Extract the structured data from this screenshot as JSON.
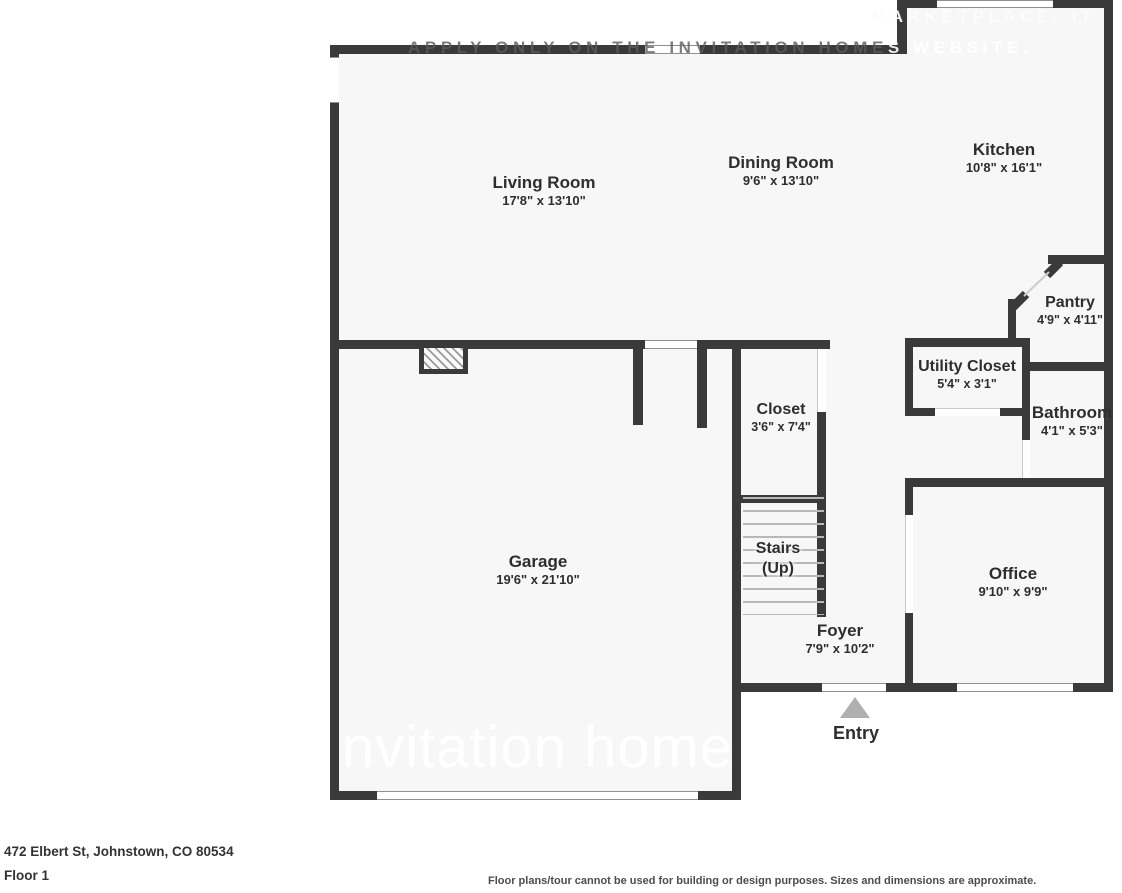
{
  "watermarks": {
    "top_line1": "MARKETPLACE, IT",
    "top_line2": "APPLY ONLY ON THE INVITATION HOMES WEBSITE.",
    "garage_logo": "invitation homes"
  },
  "rooms": {
    "living": {
      "name": "Living Room",
      "dims": "17'8\" x 13'10\""
    },
    "dining": {
      "name": "Dining Room",
      "dims": "9'6\" x 13'10\""
    },
    "kitchen": {
      "name": "Kitchen",
      "dims": "10'8\" x 16'1\""
    },
    "pantry": {
      "name": "Pantry",
      "dims": "4'9\" x 4'11\""
    },
    "utility": {
      "name": "Utility Closet",
      "dims": "5'4\" x 3'1\""
    },
    "bathroom": {
      "name": "Bathroom",
      "dims": "4'1\" x 5'3\""
    },
    "closet": {
      "name": "Closet",
      "dims": "3'6\" x 7'4\""
    },
    "stairs": {
      "name": "Stairs",
      "direction": "(Up)"
    },
    "garage": {
      "name": "Garage",
      "dims": "19'6\" x 21'10\""
    },
    "foyer": {
      "name": "Foyer",
      "dims": "7'9\" x 10'2\""
    },
    "office": {
      "name": "Office",
      "dims": "9'10\" x 9'9\""
    },
    "entry": {
      "name": "Entry"
    }
  },
  "footer": {
    "address": "472 Elbert St, Johnstown, CO 80534",
    "floor": "Floor 1",
    "disclaimer": "Floor plans/tour cannot be used for building or design purposes. Sizes and dimensions are approximate."
  },
  "colors": {
    "wall": "#3a3a3a",
    "room_fill": "#f7f7f7",
    "entry_arrow": "#b0b0b0"
  }
}
